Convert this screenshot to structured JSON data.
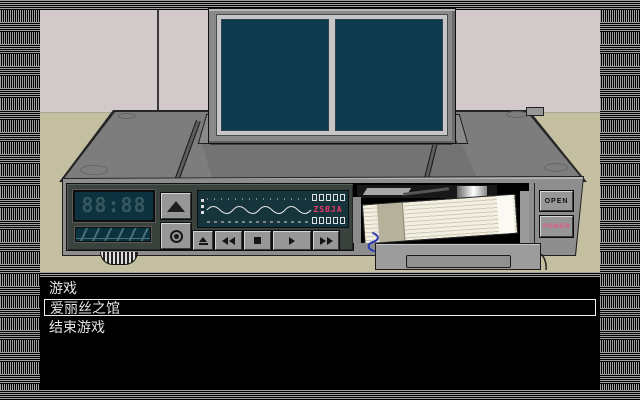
{
  "window": {
    "width": 640,
    "height": 400
  },
  "scene": {
    "description_names": [
      "wall",
      "floor",
      "video-deck",
      "flip-up-monitor",
      "cassette"
    ],
    "vcr": {
      "clock_display": "88:88",
      "signal_code": "ZSBJA",
      "buttons": {
        "open": "OPEN",
        "power": "POWER"
      }
    }
  },
  "colors": {
    "power_pink": "#e8558b",
    "signal_pink": "#ee3a6a",
    "screen_teal": "#0d3a4c",
    "lcd_teal": "#0b323e",
    "wall": "#d2caca",
    "floor": "#c3bfa0",
    "menu_text": "#e4e4e4",
    "menu_bg": "#000000"
  },
  "menu": {
    "items": [
      {
        "label": "游戏",
        "selected": false
      },
      {
        "label": "爱丽丝之馆",
        "selected": true
      },
      {
        "label": "结束游戏",
        "selected": false
      }
    ]
  }
}
